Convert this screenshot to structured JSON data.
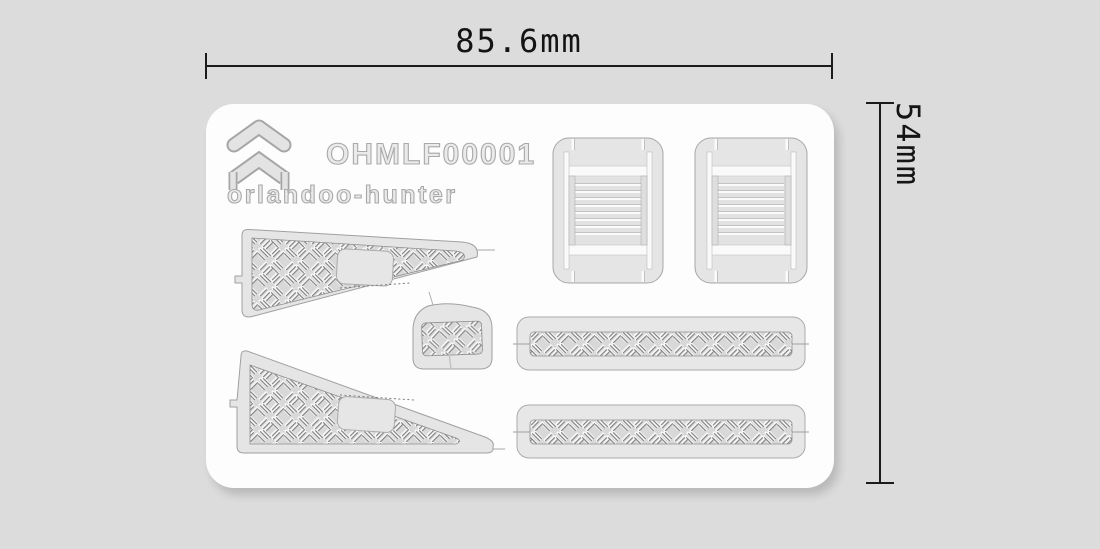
{
  "meta": {
    "background_color": "#dcdcdc",
    "card_color": "#fdfdfd",
    "part_fill": "#e5e5e5",
    "part_outline": "#a6a6a6",
    "dimension_color": "#1b1b1b",
    "texture": "diamond-plate"
  },
  "dimensions": {
    "width_label": "85.6mm",
    "height_label": "54mm"
  },
  "sheet": {
    "product_code": "OHMLF00001",
    "brand_text": "orlandoo-hunter",
    "logo": "orlandoo-hunter-chevron-logo",
    "parts": [
      {
        "name": "louver-panel-left"
      },
      {
        "name": "louver-panel-right"
      },
      {
        "name": "tread-plate-wedge-upper"
      },
      {
        "name": "tread-plate-bracket-small"
      },
      {
        "name": "tread-plate-strip-upper"
      },
      {
        "name": "tread-plate-wedge-lower"
      },
      {
        "name": "tread-plate-strip-lower"
      }
    ]
  }
}
